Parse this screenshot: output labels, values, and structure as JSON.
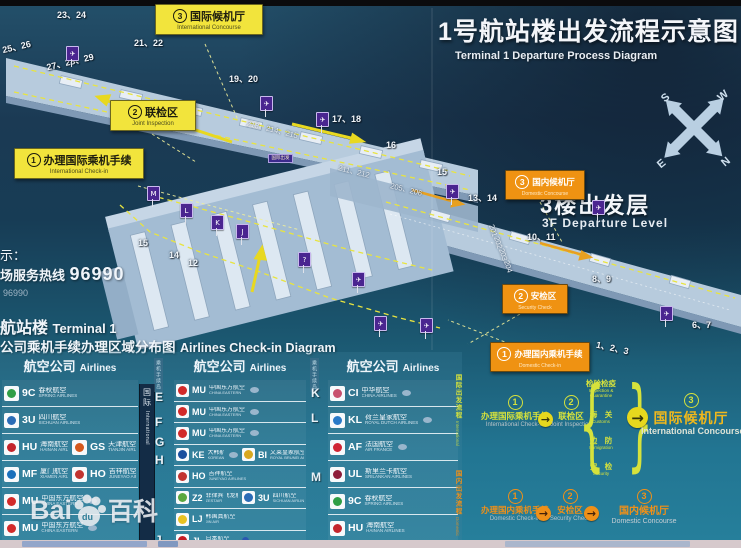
{
  "title": {
    "zh": "1号航站楼出发流程示意图",
    "en": "Terminal 1 Departure Process Diagram"
  },
  "floor": {
    "zh": "3楼出发层",
    "en": "3F Departure Level"
  },
  "compass": {
    "n": "N",
    "s": "S",
    "e": "E",
    "w": "W"
  },
  "left_panel": {
    "legend": "示：",
    "hotline_label": "场服务热线",
    "hotline_number": "96990",
    "hotline_small": "96990",
    "terminal_zh": "航站楼",
    "terminal_en": "Terminal 1",
    "diagram_zh": "公司乘机手续办理区域分布图",
    "diagram_en": "Airlines Check-in Diagram"
  },
  "map_labels": [
    {
      "id": "intl-concourse",
      "n": "3",
      "zh": "国际候机厅",
      "en": "International Concourse",
      "type": "intl",
      "x": 155,
      "y": 4,
      "w": 100
    },
    {
      "id": "joint-inspection",
      "n": "2",
      "zh": "联检区",
      "en": "Joint Inspection",
      "type": "intl",
      "x": 110,
      "y": 100,
      "w": 78
    },
    {
      "id": "intl-checkin",
      "n": "1",
      "zh": "办理国际乘机手续",
      "en": "International Check-in",
      "type": "intl",
      "x": 14,
      "y": 148,
      "w": 122
    },
    {
      "id": "dom-concourse",
      "n": "3",
      "zh": "国内候机厅",
      "en": "Domestic Concourse",
      "type": "dom",
      "x": 505,
      "y": 170,
      "w": 72
    },
    {
      "id": "dom-security",
      "n": "2",
      "zh": "安检区",
      "en": "Security Check",
      "type": "dom",
      "x": 502,
      "y": 284,
      "w": 58
    },
    {
      "id": "dom-checkin",
      "n": "1",
      "zh": "办理国内乘机手续",
      "en": "Domestic Check-in",
      "type": "dom",
      "x": 490,
      "y": 342,
      "w": 92
    }
  ],
  "gates": [
    {
      "t": "23、24",
      "x": 57,
      "y": 8
    },
    {
      "t": "25、26",
      "x": 2,
      "y": 40,
      "r": -13
    },
    {
      "t": "27、28、29",
      "x": 46,
      "y": 55,
      "r": -13
    },
    {
      "t": "21、22",
      "x": 134,
      "y": 36
    },
    {
      "t": "19、20",
      "x": 229,
      "y": 72
    },
    {
      "t": "17、18",
      "x": 332,
      "y": 112
    },
    {
      "t": "16",
      "x": 386,
      "y": 140
    },
    {
      "t": "15",
      "x": 437,
      "y": 167
    },
    {
      "t": "13、14",
      "x": 468,
      "y": 191
    },
    {
      "t": "10、11",
      "x": 527,
      "y": 230
    },
    {
      "t": "8、9",
      "x": 592,
      "y": 272
    },
    {
      "t": "6、7",
      "x": 692,
      "y": 318
    },
    {
      "t": "1、2、3",
      "x": 596,
      "y": 341,
      "r": 12
    },
    {
      "t": "15",
      "x": 138,
      "y": 238
    },
    {
      "t": "14",
      "x": 169,
      "y": 250
    },
    {
      "t": "12",
      "x": 188,
      "y": 258
    }
  ],
  "bridges": [
    {
      "t": "213、214、215",
      "x": 246,
      "y": 124,
      "r": 14
    },
    {
      "t": "211、212",
      "x": 338,
      "y": 166,
      "r": 14
    },
    {
      "t": "205、206",
      "x": 390,
      "y": 184,
      "r": 14
    },
    {
      "t": "201",
      "x": 487,
      "y": 226,
      "r": 72
    },
    {
      "t": "202",
      "x": 492,
      "y": 238,
      "r": 72
    },
    {
      "t": "203",
      "x": 497,
      "y": 250,
      "r": 72
    },
    {
      "t": "204",
      "x": 502,
      "y": 262,
      "r": 72
    }
  ],
  "signs": [
    {
      "x": 66,
      "y": 46,
      "g": "✈"
    },
    {
      "x": 260,
      "y": 96,
      "g": "✈"
    },
    {
      "x": 316,
      "y": 112,
      "g": "✈"
    },
    {
      "x": 446,
      "y": 184,
      "g": "✈"
    },
    {
      "x": 592,
      "y": 200,
      "g": "✈"
    },
    {
      "x": 660,
      "y": 306,
      "g": "✈"
    },
    {
      "x": 147,
      "y": 186,
      "g": "M"
    },
    {
      "x": 180,
      "y": 203,
      "g": "L"
    },
    {
      "x": 211,
      "y": 215,
      "g": "K"
    },
    {
      "x": 236,
      "y": 224,
      "g": "J"
    },
    {
      "x": 298,
      "y": 252,
      "g": "?"
    },
    {
      "x": 352,
      "y": 272,
      "g": "✈"
    },
    {
      "x": 374,
      "y": 316,
      "g": "✈"
    },
    {
      "x": 420,
      "y": 318,
      "g": "✈"
    }
  ],
  "mini_sign": {
    "t": "国际出发",
    "x": 268,
    "y": 154
  },
  "table": {
    "header": {
      "zh": "航空公司",
      "en": "Airlines"
    },
    "island_header": "乘机手续岛",
    "divider": {
      "zh": "国际",
      "en": "International"
    },
    "letters_mid": [
      "E",
      "F",
      "G",
      "H",
      "J"
    ],
    "letters_right": [
      "K",
      "L",
      "M"
    ],
    "columns": [
      {
        "rows": [
          [
            {
              "code": "9C",
              "zh": "春秋航空",
              "en": "SPRING AIRLINES",
              "c": "#2f9e46"
            }
          ],
          [
            {
              "code": "3U",
              "zh": "四川航空",
              "en": "SICHUAN AIRLINES",
              "c": "#2a6cb6"
            }
          ],
          [
            {
              "code": "HU",
              "zh": "海南航空",
              "en": "HAINAN AIRLINES",
              "c": "#c3242c"
            },
            {
              "code": "GS",
              "zh": "天津航空",
              "en": "TIANJIN AIRLINES",
              "c": "#d4581e"
            }
          ],
          [
            {
              "code": "MF",
              "zh": "厦门航空",
              "en": "XIAMEN AIRLINES",
              "c": "#1a70bb"
            },
            {
              "code": "HO",
              "zh": "吉祥航空",
              "en": "JUNEYAO AIRLINES",
              "c": "#c23430"
            }
          ],
          [
            {
              "code": "MU",
              "zh": "中国东方航空",
              "en": "CHINA EASTERN",
              "c": "#d22a2a",
              "a": "sky"
            }
          ],
          [
            {
              "code": "MU",
              "zh": "中国东方航空",
              "en": "CHINA EASTERN",
              "c": "#d22a2a",
              "a": "sky"
            }
          ]
        ]
      },
      {
        "rows": [
          [
            {
              "code": "MU",
              "zh": "中国东方航空",
              "en": "CHINA EASTERN",
              "c": "#d22a2a",
              "a": "sky"
            }
          ],
          [
            {
              "code": "MU",
              "zh": "中国东方航空",
              "en": "CHINA EASTERN",
              "c": "#d22a2a",
              "a": "sky"
            }
          ],
          [
            {
              "code": "MU",
              "zh": "中国东方航空",
              "en": "CHINA EASTERN",
              "c": "#d22a2a",
              "a": "sky"
            }
          ],
          [
            {
              "code": "KE",
              "zh": "大韩航空",
              "en": "KOREAN AIR",
              "c": "#1a4f9e",
              "a": "sky"
            },
            {
              "code": "BI",
              "zh": "文莱皇家航空",
              "en": "ROYAL BRUNEI AIRLINES",
              "c": "#d8a820"
            }
          ],
          [
            {
              "code": "HO",
              "zh": "吉祥航空",
              "en": "JUNEYAO AIRLINES",
              "c": "#c23430"
            }
          ],
          [
            {
              "code": "Z2",
              "zh": "菲律宾飞龙航空",
              "en": "ZESTAIR",
              "c": "#5aa83e"
            },
            {
              "code": "3U",
              "zh": "四川航空",
              "en": "SICHUAN AIRLINES",
              "c": "#2a6cb6"
            }
          ],
          [
            {
              "code": "LJ",
              "zh": "韩国真航空",
              "en": "JIN AIR",
              "c": "#e8c222"
            }
          ],
          [
            {
              "code": "JL",
              "zh": "日本航空",
              "en": "JAPAN AIRLINES",
              "c": "#c41c24",
              "a": "one"
            }
          ]
        ]
      },
      {
        "rows": [
          [
            {
              "code": "CI",
              "zh": "中华航空",
              "en": "CHINA AIRLINES",
              "c": "#c8506e",
              "a": "sky"
            }
          ],
          [
            {
              "code": "KL",
              "zh": "荷兰皇家航空",
              "en": "ROYAL DUTCH AIRLINES",
              "c": "#2a7ac8",
              "a": "sky"
            }
          ],
          [
            {
              "code": "AF",
              "zh": "法国航空",
              "en": "AIR FRANCE",
              "c": "#d02434",
              "a": "sky"
            }
          ],
          [
            {
              "code": "UL",
              "zh": "斯里兰卡航空",
              "en": "SRILANKAN AIRLINES",
              "c": "#8e1c3a"
            }
          ],
          [
            {
              "code": "9C",
              "zh": "春秋航空",
              "en": "SPRING AIRLINES",
              "c": "#2f9e46"
            }
          ],
          [
            {
              "code": "HU",
              "zh": "海南航空",
              "en": "HAINAN AIRLINES",
              "c": "#c3242c"
            }
          ]
        ]
      }
    ]
  },
  "flow": {
    "intl": {
      "strip_zh": "国际出发流程",
      "strip_en": "International Departure",
      "steps": [
        {
          "n": "1",
          "zh": "办理国际乘机手续",
          "en": "International Check-in"
        },
        {
          "n": "2",
          "zh": "联检区",
          "en": "Joint Inspection"
        },
        {
          "n": "3",
          "zh": "国际候机厅",
          "en": "International Concourse"
        }
      ],
      "brace": [
        {
          "zh": "检验检疫",
          "en": "Inspection &|Quarantine"
        },
        {
          "zh": "海　关",
          "en": "Customs"
        },
        {
          "zh": "边　防",
          "en": "Immigration"
        },
        {
          "zh": "安　检",
          "en": "Security"
        }
      ]
    },
    "dom": {
      "strip_zh": "国内出发流程",
      "strip_en": "Domestic Departure",
      "steps": [
        {
          "n": "1",
          "zh": "办理国内乘机手续",
          "en": "Domestic Check-in"
        },
        {
          "n": "2",
          "zh": "安检区",
          "en": "Security Check"
        },
        {
          "n": "3",
          "zh": "国内候机厅",
          "en": "Domestic Concourse"
        }
      ]
    }
  },
  "watermark": {
    "p1": "Bai",
    "p2": "du",
    "p3": "百科"
  },
  "colors": {
    "label_intl": "#f2e43c",
    "label_dom": "#ef9212",
    "flow_intl": "#d6e23c",
    "flow_dom": "#f09018",
    "pier": "#b7cbdd",
    "sign_purple": "#4a2590"
  }
}
